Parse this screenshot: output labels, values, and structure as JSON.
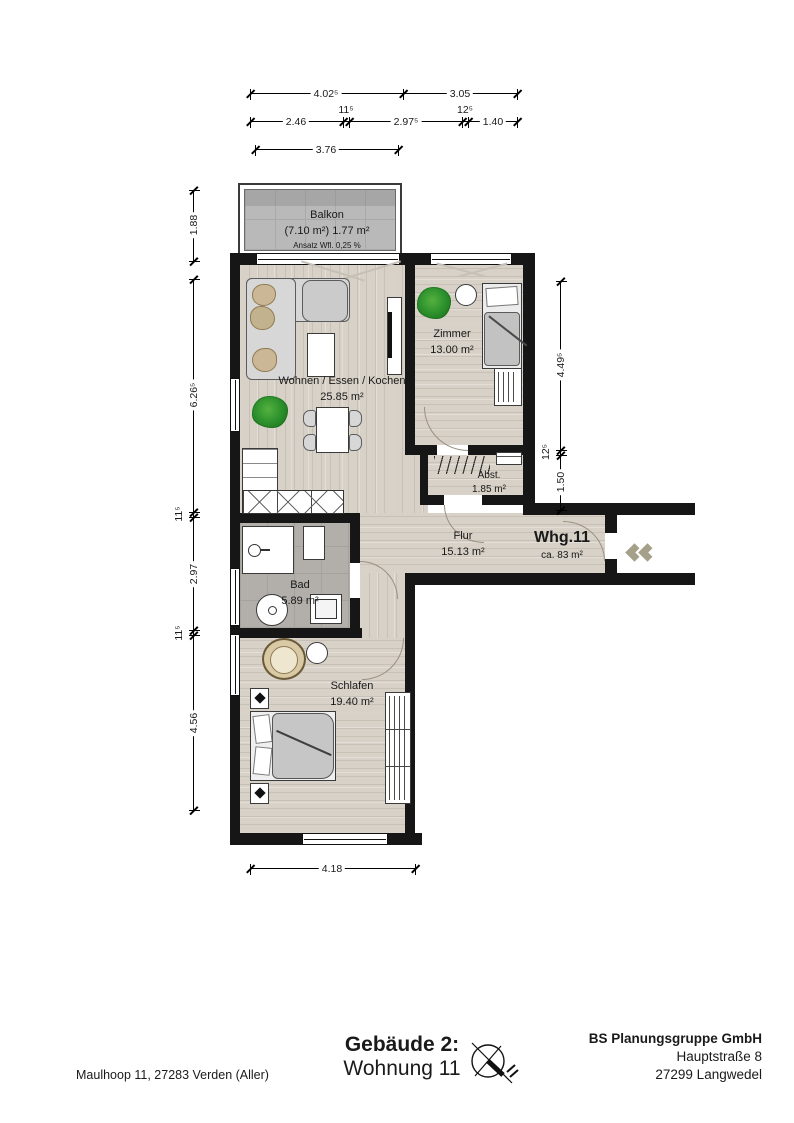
{
  "plan": {
    "rooms": {
      "balkon": {
        "name": "Balkon",
        "area_line": "(7.10 m²) 1.77 m²",
        "note": "Ansatz Wfl. 0,25 %"
      },
      "wohnen": {
        "name": "Wohnen / Essen / Kochen",
        "area": "25.85 m²"
      },
      "zimmer": {
        "name": "Zimmer",
        "area": "13.00 m²"
      },
      "abstellraum": {
        "name": "Abst.",
        "area": "1.85 m²"
      },
      "flur": {
        "name": "Flur",
        "area": "15.13 m²"
      },
      "bad": {
        "name": "Bad",
        "area": "5.89 m²"
      },
      "schlafen": {
        "name": "Schlafen",
        "area": "19.40 m²"
      },
      "wohnung": {
        "name": "Whg.11",
        "area": "ca. 83 m²"
      }
    },
    "dimensions": {
      "top_row1": [
        "4.02⁵",
        "3.05"
      ],
      "top_row2": [
        "2.46",
        "11⁵",
        "2.97⁵",
        "12⁵",
        "1.40"
      ],
      "top_row3": [
        "3.76"
      ],
      "left": [
        "1.88",
        "6.26⁵",
        "11⁵",
        "2.97",
        "11⁵",
        "4.56"
      ],
      "right": [
        "4.49⁵",
        "12⁵",
        "1.50"
      ],
      "bottom": [
        "4.18"
      ]
    }
  },
  "footer": {
    "building": "Gebäude 2:",
    "unit": "Wohnung 11",
    "site_address": "Maulhoop 11, 27283 Verden (Aller)",
    "company": {
      "name": "BS Planungsgruppe GmbH",
      "street": "Hauptstraße 8",
      "city": "27299 Langwedel"
    }
  },
  "colors": {
    "wall": "#161616",
    "floor_wood": "#d7d1c7",
    "floor_tile": "#b2afaa",
    "balcony": "#b9b9b9",
    "plant": "#2d922d",
    "chevron": "#a5a08a"
  }
}
